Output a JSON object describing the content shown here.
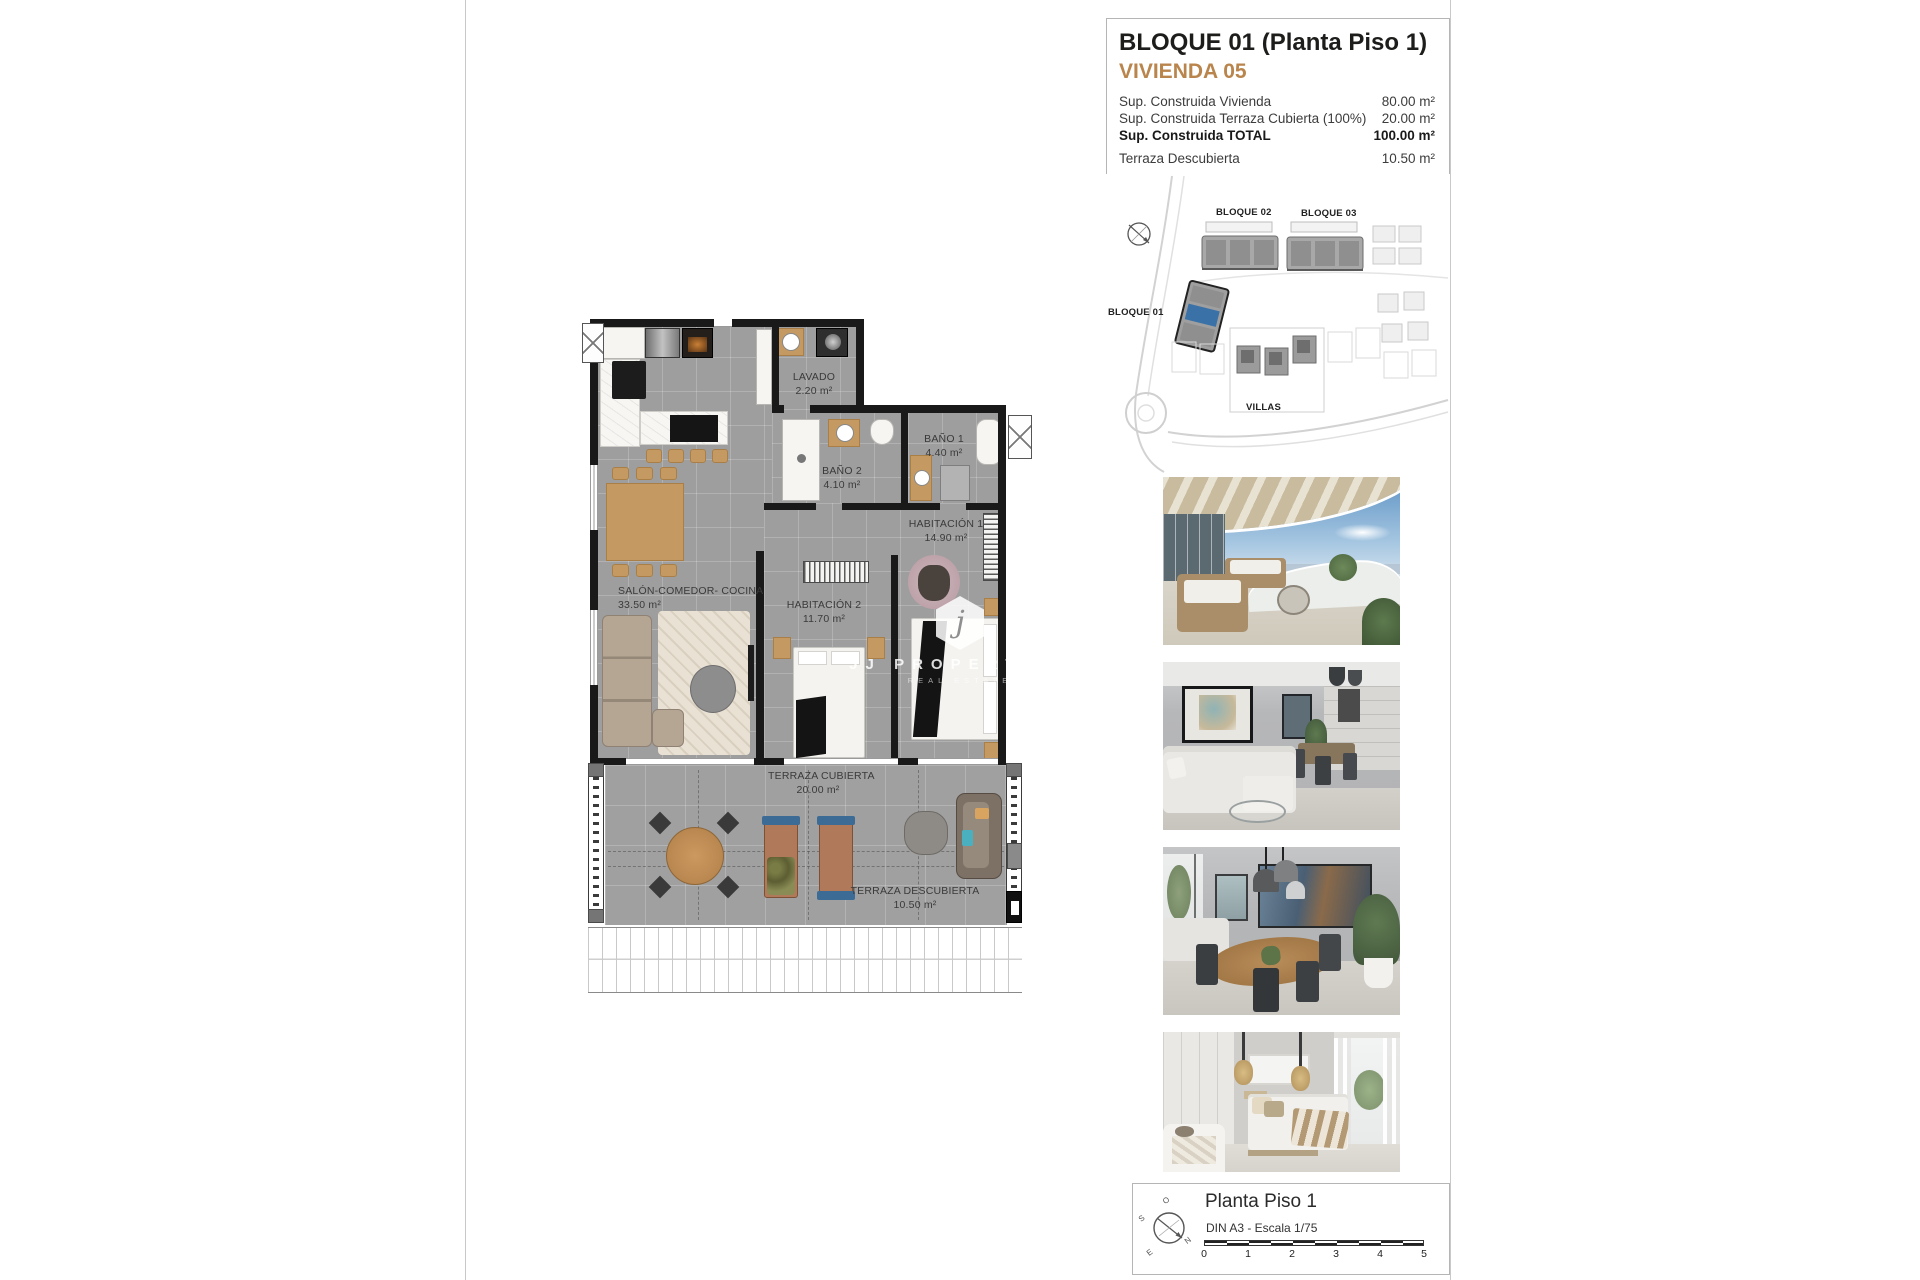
{
  "header": {
    "title": "BLOQUE 01  (Planta Piso 1)",
    "subtitle": "VIVIENDA 05",
    "accent_color": "#b9854c",
    "rows": [
      {
        "label": "Sup. Construida Vivienda",
        "value": "80.00 m²"
      },
      {
        "label": "Sup. Construida Terraza Cubierta (100%)",
        "value": "20.00 m²"
      },
      {
        "label": "Sup. Construida TOTAL",
        "value": "100.00 m²"
      },
      {
        "label": "Terraza Descubierta",
        "value": "10.50 m²"
      }
    ]
  },
  "site_plan": {
    "bloque01": "BLOQUE 01",
    "bloque02": "BLOQUE 02",
    "bloque03": "BLOQUE 03",
    "villas": "VILLAS",
    "highlight_color": "#3a72a8"
  },
  "floor_plan": {
    "wall_color": "#191919",
    "floor_color": "#9e9e9e",
    "rooms": {
      "lavado": {
        "name": "LAVADO",
        "area": "2.20 m²"
      },
      "bano2": {
        "name": "BAÑO 2",
        "area": "4.10 m²"
      },
      "bano1": {
        "name": "BAÑO 1",
        "area": "4.40 m²"
      },
      "habitacion1": {
        "name": "HABITACIÓN 1",
        "area": "14.90 m²"
      },
      "habitacion2": {
        "name": "HABITACIÓN 2",
        "area": "11.70 m²"
      },
      "salon": {
        "name": "SALÓN-COMEDOR- COCINA",
        "area": "33.50 m²"
      },
      "terraza_cubierta": {
        "name": "TERRAZA CUBIERTA",
        "area": "20.00 m²"
      },
      "terraza_descubierta": {
        "name": "TERRAZA DESCUBIERTA",
        "area": "10.50 m²"
      }
    }
  },
  "watermark": {
    "monogram": "j",
    "brand": "JJ PROPERTIES",
    "tagline": "REAL ESTATE"
  },
  "photos": {
    "items": [
      {
        "name": "terrace"
      },
      {
        "name": "living-room"
      },
      {
        "name": "dining-room"
      },
      {
        "name": "bedroom"
      }
    ]
  },
  "footer": {
    "title": "Planta Piso 1",
    "scale_text": "DIN A3 - Escala 1/75",
    "scale_ticks": [
      "0",
      "1",
      "2",
      "3",
      "4",
      "5"
    ],
    "compass": {
      "o": "O",
      "s": "S",
      "n": "N",
      "e": "E"
    }
  }
}
